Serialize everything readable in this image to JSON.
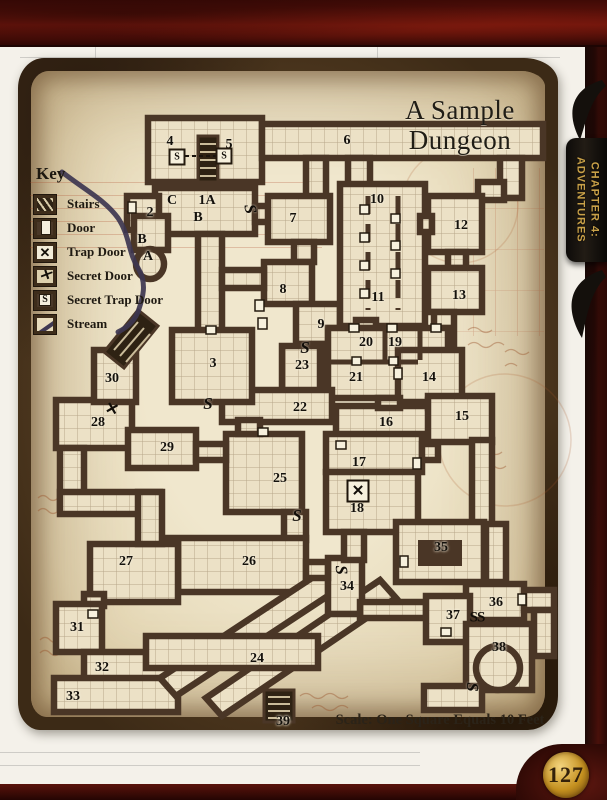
{
  "page": {
    "number": "127"
  },
  "book_tab": {
    "line1": "CHAPTER 4:",
    "line2": "ADVENTURES"
  },
  "map": {
    "title_line1": "A Sample",
    "title_line2": "Dungeon",
    "scale_note": "Scale: One Square Equals 10 Feet",
    "key": {
      "heading": "Key",
      "items": [
        {
          "label": "Stairs",
          "icon": "ki-stairs",
          "icon_name": "stairs-icon",
          "glyph": ""
        },
        {
          "label": "Door",
          "icon": "ki-door",
          "icon_name": "door-icon",
          "glyph": ""
        },
        {
          "label": "Trap Door",
          "icon": "ki-trapdoor",
          "icon_name": "trap-door-icon",
          "glyph": "✕"
        },
        {
          "label": "Secret Door",
          "icon": "ki-secretdoor",
          "icon_name": "secret-door-icon",
          "glyph": "✕"
        },
        {
          "label": "Secret Trap Door",
          "icon": "ki-secrettrapdoor",
          "icon_name": "secret-trap-door-icon",
          "glyph": "S"
        },
        {
          "label": "Stream",
          "icon": "ki-stream",
          "icon_name": "stream-icon",
          "glyph": ""
        }
      ]
    },
    "rooms": [
      {
        "n": "4",
        "x": 170,
        "y": 142
      },
      {
        "n": "5",
        "x": 229,
        "y": 145
      },
      {
        "n": "6",
        "x": 347,
        "y": 141
      },
      {
        "n": "2",
        "x": 150,
        "y": 213
      },
      {
        "n": "C",
        "x": 172,
        "y": 201
      },
      {
        "n": "1A",
        "x": 207,
        "y": 201
      },
      {
        "n": "B",
        "x": 198,
        "y": 218
      },
      {
        "n": "7",
        "x": 293,
        "y": 219
      },
      {
        "n": "B",
        "x": 142,
        "y": 240
      },
      {
        "n": "A",
        "x": 148,
        "y": 257
      },
      {
        "n": "8",
        "x": 283,
        "y": 290
      },
      {
        "n": "10",
        "x": 377,
        "y": 200
      },
      {
        "n": "11",
        "x": 378,
        "y": 298
      },
      {
        "n": "12",
        "x": 461,
        "y": 226
      },
      {
        "n": "13",
        "x": 459,
        "y": 296
      },
      {
        "n": "9",
        "x": 321,
        "y": 325
      },
      {
        "n": "20",
        "x": 366,
        "y": 343
      },
      {
        "n": "19",
        "x": 395,
        "y": 343
      },
      {
        "n": "23",
        "x": 302,
        "y": 366
      },
      {
        "n": "21",
        "x": 356,
        "y": 378
      },
      {
        "n": "14",
        "x": 429,
        "y": 378
      },
      {
        "n": "22",
        "x": 300,
        "y": 408
      },
      {
        "n": "16",
        "x": 386,
        "y": 423
      },
      {
        "n": "15",
        "x": 462,
        "y": 417
      },
      {
        "n": "3",
        "x": 213,
        "y": 364
      },
      {
        "n": "30",
        "x": 112,
        "y": 379
      },
      {
        "n": "28",
        "x": 98,
        "y": 423
      },
      {
        "n": "29",
        "x": 167,
        "y": 448
      },
      {
        "n": "25",
        "x": 280,
        "y": 479
      },
      {
        "n": "17",
        "x": 359,
        "y": 463
      },
      {
        "n": "18",
        "x": 357,
        "y": 509
      },
      {
        "n": "26",
        "x": 249,
        "y": 562
      },
      {
        "n": "27",
        "x": 126,
        "y": 562
      },
      {
        "n": "31",
        "x": 77,
        "y": 628
      },
      {
        "n": "32",
        "x": 102,
        "y": 668
      },
      {
        "n": "33",
        "x": 73,
        "y": 697
      },
      {
        "n": "24",
        "x": 257,
        "y": 659
      },
      {
        "n": "39",
        "x": 283,
        "y": 722
      },
      {
        "n": "34",
        "x": 347,
        "y": 587
      },
      {
        "n": "35",
        "x": 441,
        "y": 548
      },
      {
        "n": "36",
        "x": 496,
        "y": 603
      },
      {
        "n": "37",
        "x": 453,
        "y": 616
      },
      {
        "n": "38",
        "x": 499,
        "y": 648
      }
    ],
    "symbols": [
      {
        "t": "S",
        "kind": "k-sbox",
        "x": 177,
        "y": 157
      },
      {
        "t": "S",
        "kind": "k-sbox",
        "x": 224,
        "y": 156
      },
      {
        "t": "S",
        "kind": "k-s",
        "x": 250,
        "y": 209,
        "rot": 80
      },
      {
        "t": "S",
        "kind": "k-s",
        "x": 305,
        "y": 348
      },
      {
        "t": "S",
        "kind": "k-s",
        "x": 208,
        "y": 404
      },
      {
        "t": "S",
        "kind": "k-s",
        "x": 297,
        "y": 516
      },
      {
        "t": "S",
        "kind": "k-s",
        "x": 341,
        "y": 570,
        "rot": 85
      },
      {
        "t": "SS",
        "kind": "k-ss",
        "x": 477,
        "y": 618
      },
      {
        "t": "S",
        "kind": "k-s",
        "x": 472,
        "y": 687,
        "rot": 90
      },
      {
        "t": "✕",
        "kind": "k-xbox",
        "x": 358,
        "y": 491
      },
      {
        "t": "✕",
        "kind": "k-x",
        "x": 112,
        "y": 409,
        "rot": 15
      }
    ],
    "colors": {
      "parchment": "#e9ddc0",
      "wall": "#4a3626",
      "stream": "#3d3650",
      "binding_red": "#5a130b",
      "tab_gold": "#c9a148"
    }
  }
}
